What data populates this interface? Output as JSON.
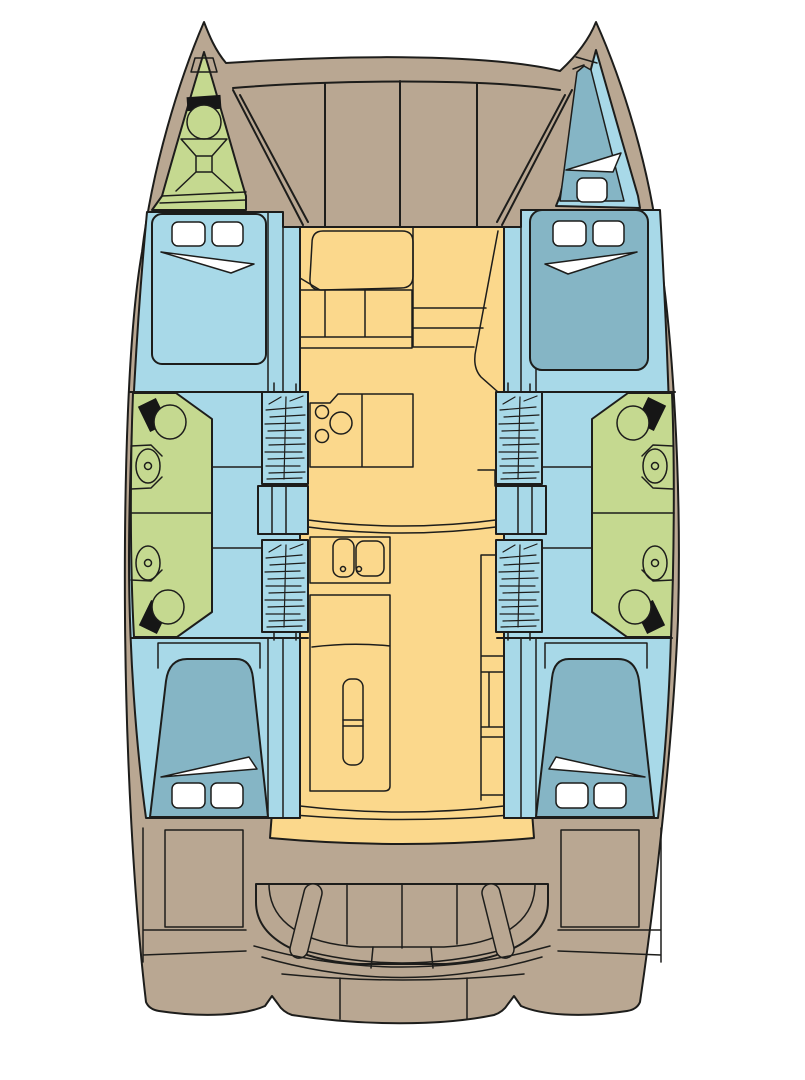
{
  "figure": {
    "type": "boat-floor-plan",
    "vessel": "catamaran",
    "orientation": "bow-up",
    "features": {
      "double_berths": 4,
      "bow_berth": 1,
      "bathroom_compartments": 4,
      "toilets": 4,
      "washbasins": 4,
      "companionway_stairs": 4,
      "galley_sink_basins": 2,
      "stove_burners": 3,
      "anchor_locker": 1,
      "cockpit_bench_sections": 4,
      "cockpit_armrests": 2,
      "foredeck_panels": 4
    }
  },
  "colors": {
    "background": "#ffffff",
    "outline": "#1d1d1b",
    "deck": "#b9a792",
    "deck_shadow": "#a79581",
    "interior_floor": "#fbd88c",
    "cabin_floor": "#a8d9e8",
    "berth": "#85b5c5",
    "wet_area": "#c5d990",
    "fitting_white": "#ffffff",
    "fitting_black": "#161616"
  }
}
